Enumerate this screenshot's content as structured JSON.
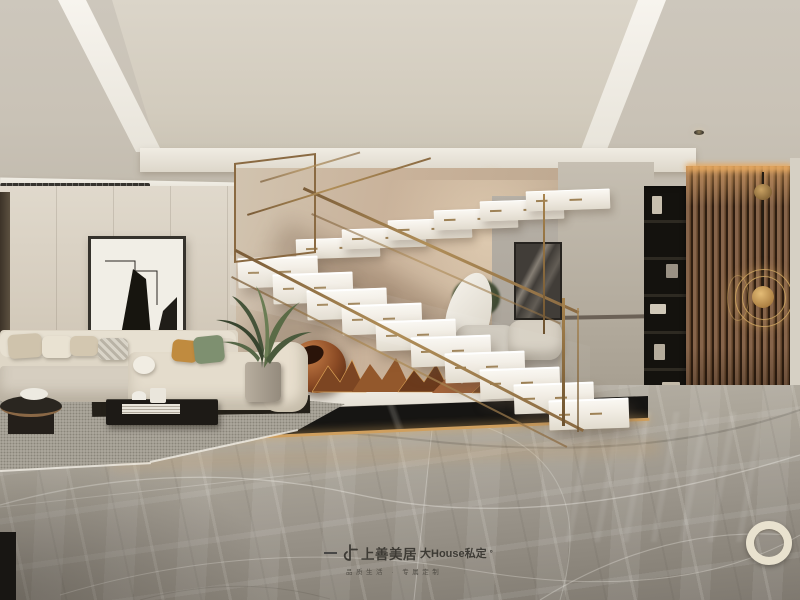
{
  "watermark": {
    "brand": "上善美居",
    "product": "大House私定",
    "degree_mark": "°",
    "tagline": "品质生活 · 专属定制"
  },
  "scene": {
    "type": "interior-design-rendering",
    "room": "duplex living room with floating marble switchback staircase",
    "objects": [
      "coffered ceiling with angled cove lighting",
      "linear ac diffuser",
      "recessed downlights",
      "black-framed abstract wall art",
      "cream sectional sofa with throw pillows",
      "black coffee table with books",
      "round dark side table with bowl",
      "grey textured area rug",
      "potted green plant",
      "floating white marble stairs with gold inlays",
      "brass and glass stair railing",
      "copper abstract sculpture display",
      "black marble platform with gold light strip",
      "white leaf sculpture",
      "grey lounge chairs",
      "dark hallway artwork",
      "black open display shelf",
      "walnut vertical slat feature wall",
      "brass concentric-ring wall lamp",
      "grey marble tile floor with veining",
      "cream decorative floor ring"
    ]
  },
  "palette": {
    "ceiling": "#cfc9be",
    "cove_light": "#f7f4ee",
    "wall_left": "#d6cec0",
    "wall_stair": "#c6b098",
    "steps_white": "#f3efe8",
    "brass": "#9c7a4c",
    "copper": "#a05c2e",
    "platform_black": "#161513",
    "glow_gold": "#d9a55f",
    "slat_wood": "#6e503a",
    "shelf_black": "#14120e",
    "sofa_cream": "#e0d8c8",
    "pillow_mustard": "#c08b3f",
    "pillow_sage": "#7e9070",
    "plant_green": "#4e5c40",
    "floor_marble": "#a09a8f",
    "watermark_ink": "#2f2d28"
  }
}
